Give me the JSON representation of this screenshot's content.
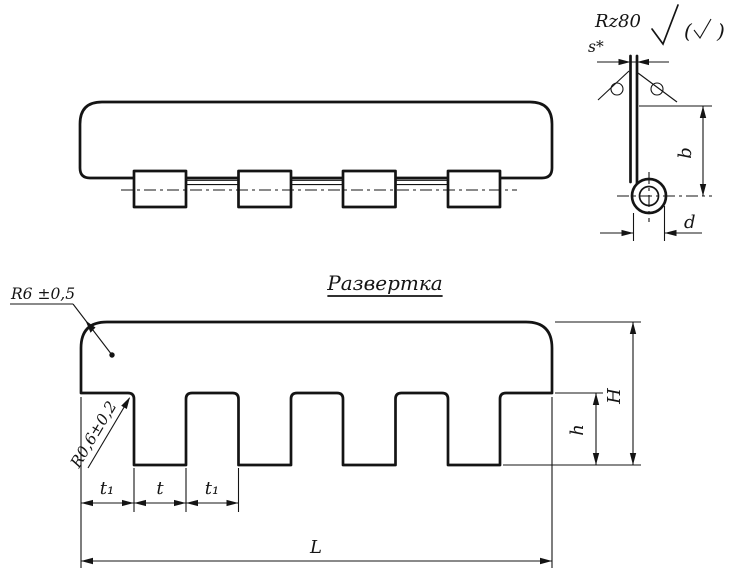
{
  "colors": {
    "ink": "#141414",
    "paper": "#ffffff"
  },
  "views": {
    "side": {
      "roughness": "Rz80",
      "paren_open": "(",
      "paren_close": ")",
      "thickness": "s*",
      "height": "b",
      "diameter": "d"
    },
    "development": {
      "title": "Развертка",
      "corner_radius": "R6 ±0,5",
      "notch_radius": "R0,6±0,2",
      "dims": {
        "t1_left": "t₁",
        "t": "t",
        "t1_right": "t₁",
        "length": "L",
        "h": "h",
        "H": "H"
      }
    }
  }
}
